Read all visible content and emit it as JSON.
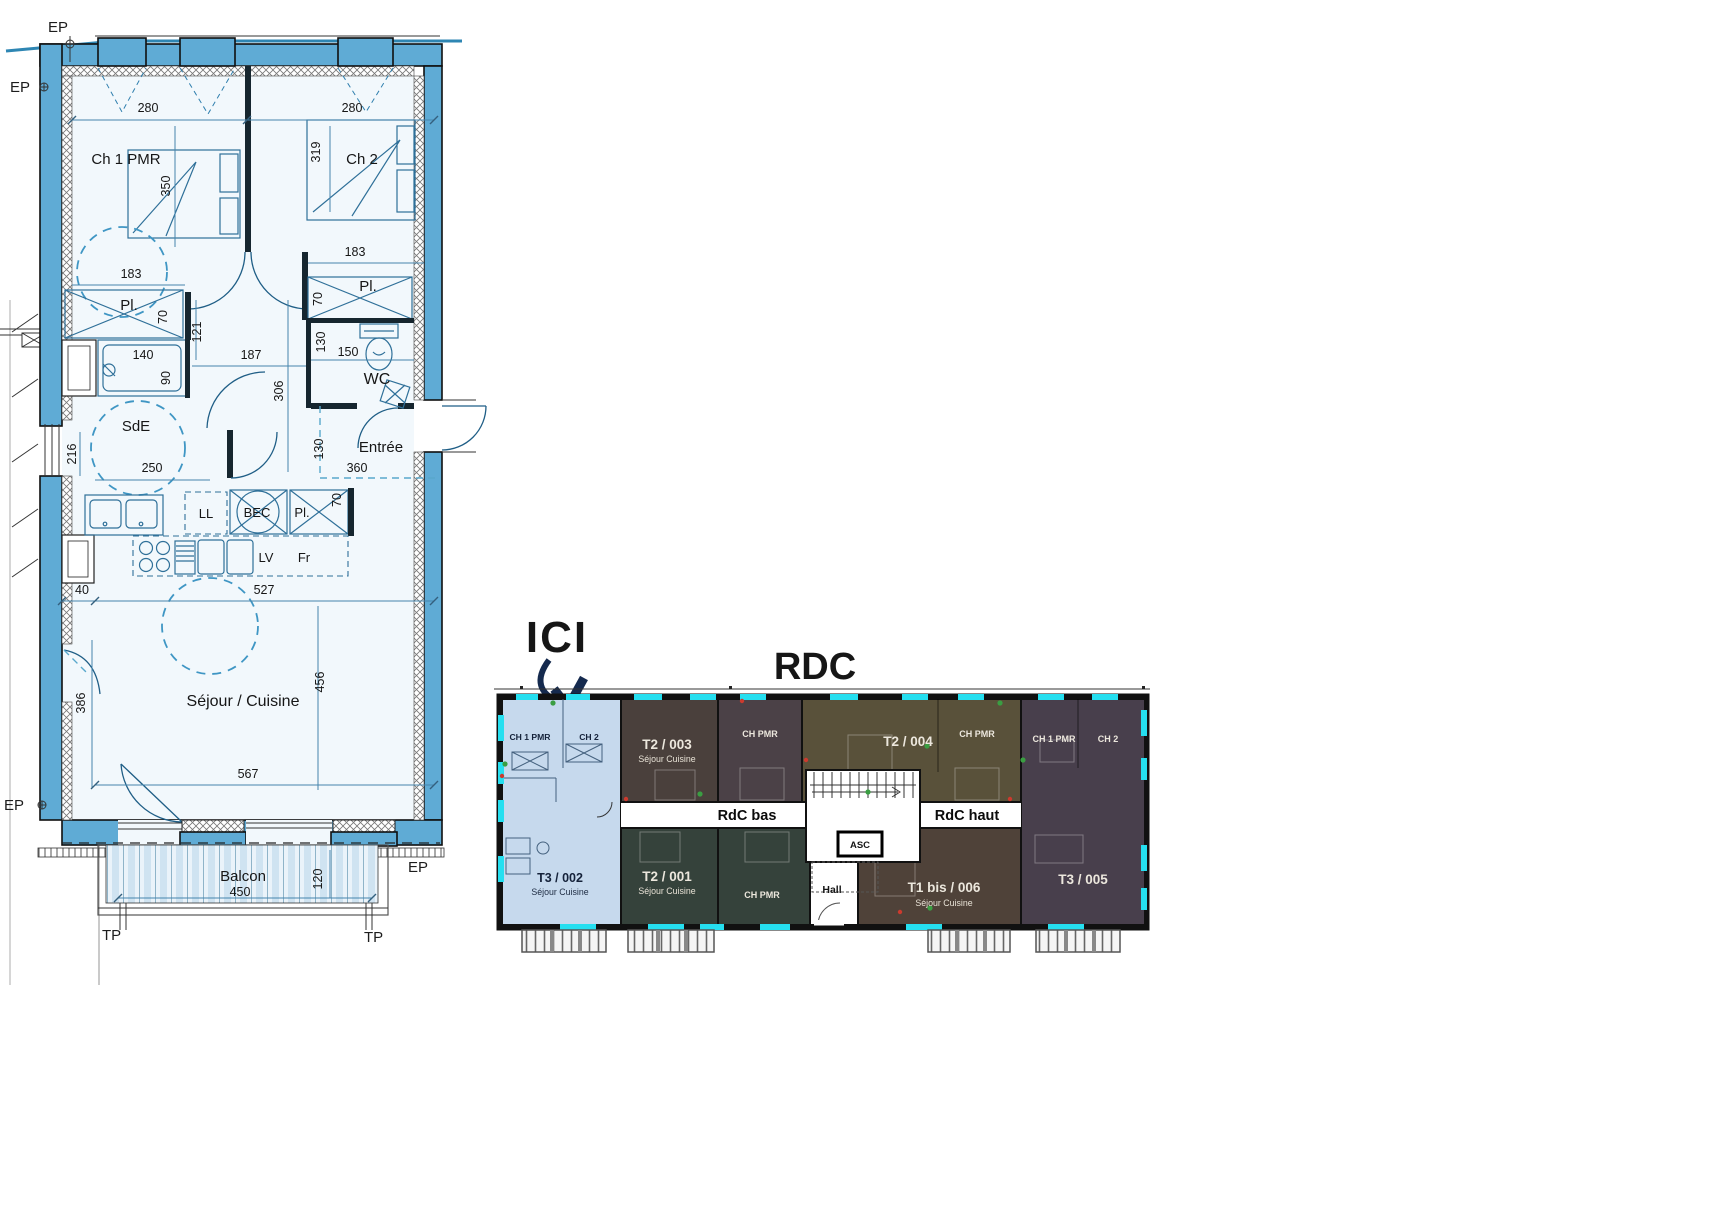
{
  "detail_plan": {
    "markers": {
      "ep": "EP",
      "tp": "TP"
    },
    "rooms": {
      "ch1": "Ch 1 PMR",
      "ch2": "Ch 2",
      "pl": "Pl.",
      "sde": "SdE",
      "wc": "WC",
      "entree": "Entrée",
      "sejour": "Séjour / Cuisine",
      "balcon": "Balcon"
    },
    "appliances": {
      "ll": "LL",
      "bec": "BEC",
      "lv": "LV",
      "fr": "Fr"
    },
    "dims": {
      "ch1_w": "280",
      "ch2_w": "280",
      "ch2_h": "319",
      "ch1_h": "350",
      "ch1_cl": "183",
      "ch2_cl": "183",
      "pl_left_d": "70",
      "pl_right_d": "70",
      "pl_kitchen_d": "70",
      "hall_w": "121",
      "hall_l": "187",
      "hall_h": "306",
      "shower_w": "140",
      "shower_d": "90",
      "wc_w": "150",
      "wc_d": "130",
      "sde_d": "216",
      "sde_w": "250",
      "entree_d": "130",
      "entree_w": "360",
      "kitchen_off": "40",
      "sejour_w1": "527",
      "sejour_h": "456",
      "sejour_side": "386",
      "sejour_w2": "567",
      "balcon_w": "450",
      "balcon_d": "120"
    }
  },
  "overview_plan": {
    "title": "RDC",
    "here": "ICI",
    "corridors": {
      "left": "RdC bas",
      "right": "RdC haut"
    },
    "elevator": "ASC",
    "hall": "Hall",
    "units": {
      "t3_002": {
        "id": "T3 / 002",
        "living": "Séjour Cuisine",
        "room1": "CH 1 PMR",
        "room2": "CH 2",
        "color": "#c6d9ed"
      },
      "t2_003": {
        "id": "T2 / 003",
        "living": "Séjour Cuisine",
        "color": "#4a403c"
      },
      "ch_pmr_top": {
        "label": "CH PMR",
        "color": "#4b4147"
      },
      "t2_004": {
        "id": "T2 / 004",
        "room": "CH PMR",
        "color": "#59513a"
      },
      "t3_005": {
        "id": "T3 / 005",
        "room1": "CH 1 PMR",
        "room2": "CH 2",
        "color": "#483f4c"
      },
      "t2_001": {
        "id": "T2 / 001",
        "living": "Séjour Cuisine",
        "room": "CH PMR",
        "color": "#35423b"
      },
      "t1bis_006": {
        "id": "T1 bis / 006",
        "living": "Séjour Cuisine",
        "color": "#4f4239"
      }
    },
    "colors": {
      "window_cyan": "#25dff0",
      "accent_navy": "#152a4e",
      "title_navy": "#3c4b7d",
      "highlight_unit": "#c6d9ed"
    }
  },
  "palette": {
    "wall_blue": "#5fabd5",
    "room_fill": "#f2f8fc",
    "dim_line": "#4585ad"
  }
}
